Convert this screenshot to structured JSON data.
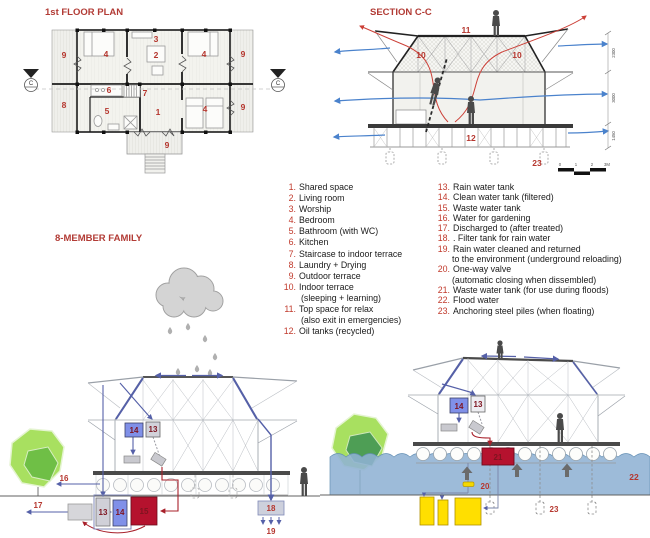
{
  "floor_plan": {
    "title": "1st FLOOR PLAN",
    "section_marker": "C",
    "rooms": {
      "terrace_left": "9",
      "bed_top_left": "4",
      "worship": "3",
      "living": "2",
      "bed_top_right": "4",
      "terrace_top_right": "9",
      "laundry": "8",
      "kitchen": "6",
      "staircase": "7",
      "shared": "1",
      "bathroom": "5",
      "bed_bottom_right": "4",
      "terrace_bottom_right": "9",
      "porch": "9"
    }
  },
  "section": {
    "title": "SECTION C-C",
    "labels": {
      "top_space": "11",
      "attic_left": "10",
      "attic_right": "10",
      "oil_tanks": "12",
      "piles": "23"
    },
    "dimensions": [
      "2300",
      "3000",
      "1450"
    ],
    "scale_ticks": [
      "0",
      "1",
      "2",
      "3M"
    ]
  },
  "legend_left": [
    {
      "num": "1.",
      "text": "Shared space"
    },
    {
      "num": "2.",
      "text": "Living room"
    },
    {
      "num": "3.",
      "text": "Worship"
    },
    {
      "num": "4.",
      "text": "Bedroom"
    },
    {
      "num": "5.",
      "text": "Bathroom (with WC)"
    },
    {
      "num": "6.",
      "text": "Kitchen"
    },
    {
      "num": "7.",
      "text": "Staircase to indoor terrace"
    },
    {
      "num": "8.",
      "text": "Laundry + Drying"
    },
    {
      "num": "9.",
      "text": "Outdoor terrace"
    },
    {
      "num": "10.",
      "text": "Indoor terrace",
      "line2": "(sleeping + learning)"
    },
    {
      "num": "11.",
      "text": "Top space for relax",
      "line2": "(also exit in emergencies)"
    },
    {
      "num": "12.",
      "text": "Oil tanks (recycled)"
    }
  ],
  "legend_right": [
    {
      "num": "13.",
      "text": "Rain water tank"
    },
    {
      "num": "14.",
      "text": "Clean water tank (filtered)"
    },
    {
      "num": "15.",
      "text": "Waste water tank"
    },
    {
      "num": "16.",
      "text": "Water for gardening"
    },
    {
      "num": "17.",
      "text": "Discharged to (after treated)"
    },
    {
      "num": "18.",
      "text": ". Filter tank for rain water"
    },
    {
      "num": "19.",
      "text": "Rain water cleaned and returned",
      "line2": "to the environment (underground reloading)"
    },
    {
      "num": "20.",
      "text": "One-way valve",
      "line2": "(automatic closing when dissembled)"
    },
    {
      "num": "21.",
      "text": "Waste water tank (for use during floods)"
    },
    {
      "num": "22.",
      "text": "Flood water"
    },
    {
      "num": "23.",
      "text": "Anchoring steel piles (when floating)"
    }
  ],
  "diagram_family": {
    "title": "8-MEMBER FAMILY",
    "labels": {
      "tank14_upper": "14",
      "tank13_upper": "13",
      "tank13_lower": "13",
      "tank14_lower": "14",
      "tank15": "15",
      "gardening": "16",
      "discharged": "17",
      "filter_tank": "18",
      "underground": "19"
    }
  },
  "diagram_flood": {
    "labels": {
      "tank14": "14",
      "tank13": "13",
      "tank21": "21",
      "valve": "20",
      "flood_water": "22",
      "piles": "23"
    }
  },
  "colors": {
    "title_red": "#b23b35",
    "legend_number_red": "#c0392b",
    "text_black": "#1a1a1a",
    "arrow_blue": "#4a82cc",
    "pipe_blue": "#5560a8",
    "hot_air_red": "#cc4038",
    "water_blue": "#8fb2d4",
    "tank_gray": "#d0d0d8",
    "tank_blue": "#8090e8",
    "tank_crimson": "#b5122e",
    "tank_yellow": "#ffdf00",
    "tree_green_light": "#a8e060",
    "tree_green_dark": "#57a84e",
    "cloud_gray": "#d4d4d4",
    "figure_gray": "#4a4a4a",
    "frame_gray": "#b8bcc2"
  }
}
